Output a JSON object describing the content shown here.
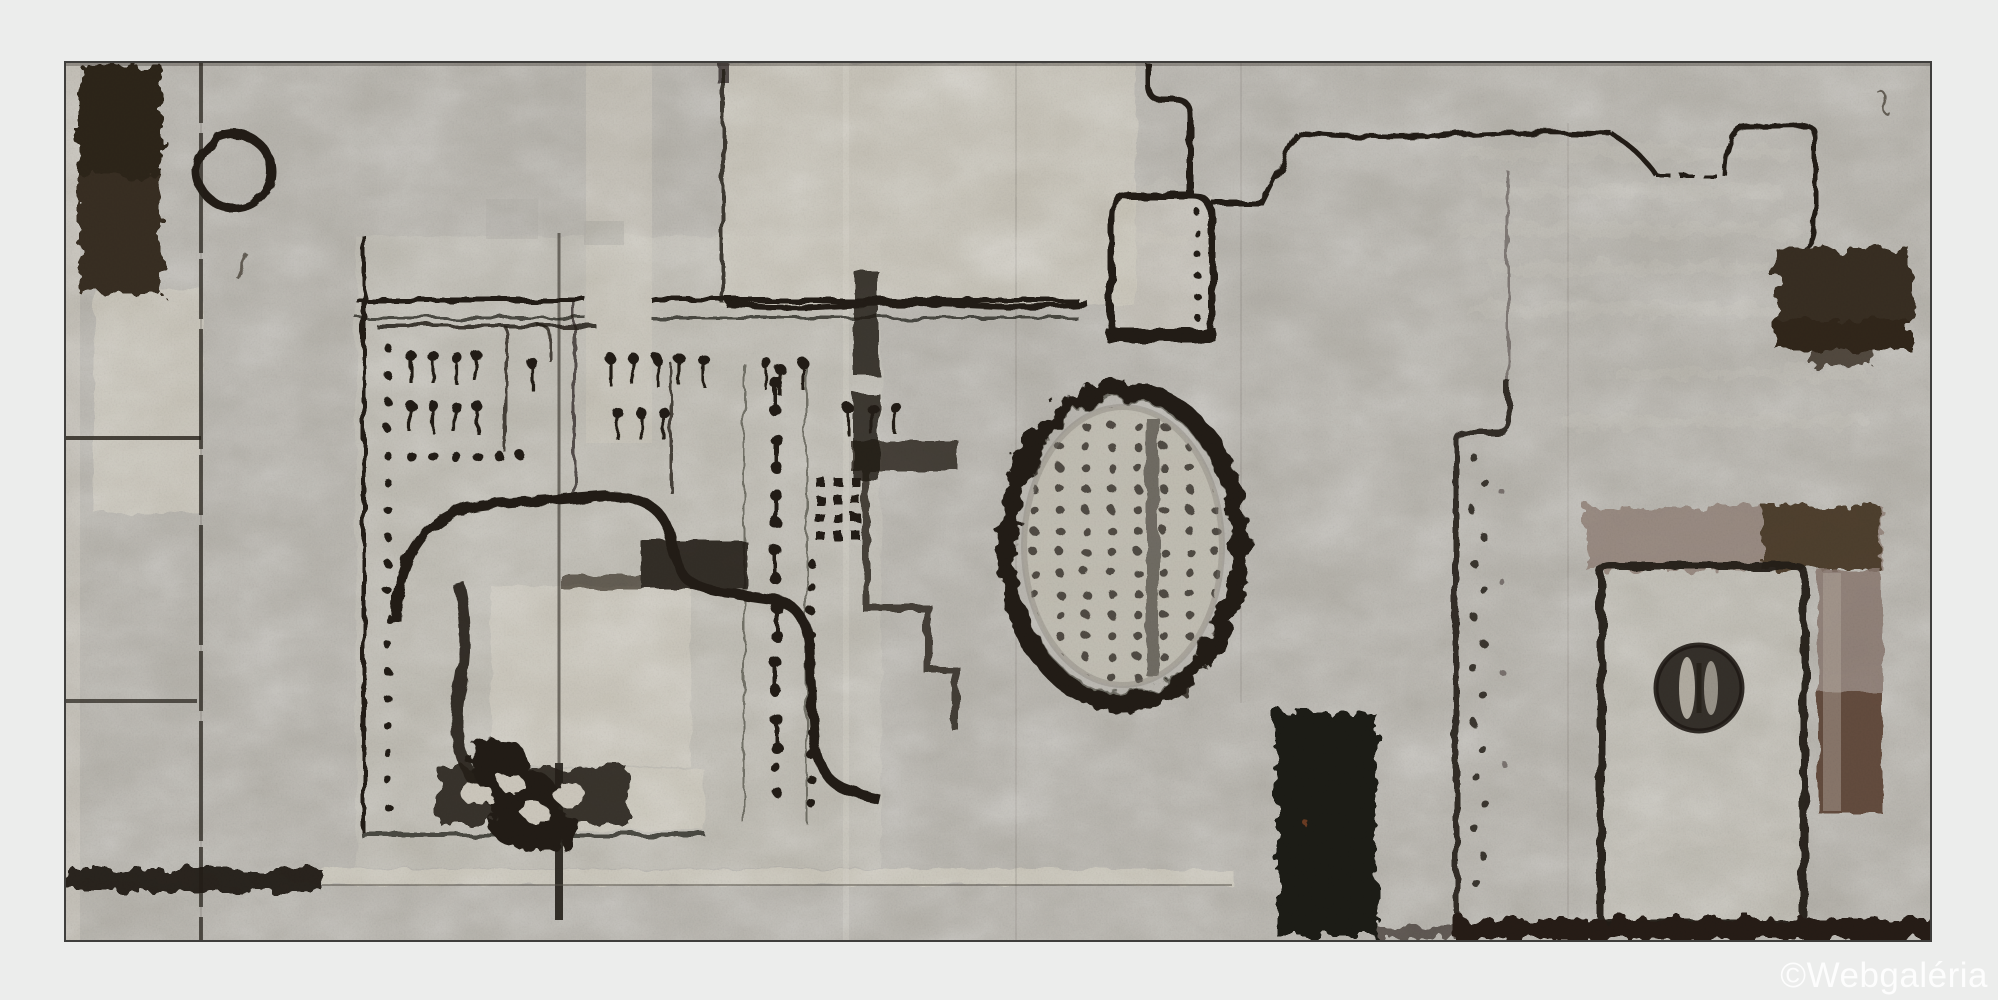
{
  "artwork": {
    "kind": "Photograph of an abstract grey mixed-media painting with collaged circuit-board motifs, an oval stamp, dark brown blocks and outlined door shape",
    "watermark": "©Webgaléria"
  },
  "palette": {
    "page_bg": "#ecedec",
    "frame_line": "#3f3e3c",
    "canvas_base": "#b4b1aa",
    "canvas_light": "#cbc7bb",
    "ink": "#241f18",
    "dark_brown": "#382e22",
    "mauve": "#93837a",
    "red_brown": "#5e4639",
    "watermark_color": "#ffffff"
  }
}
